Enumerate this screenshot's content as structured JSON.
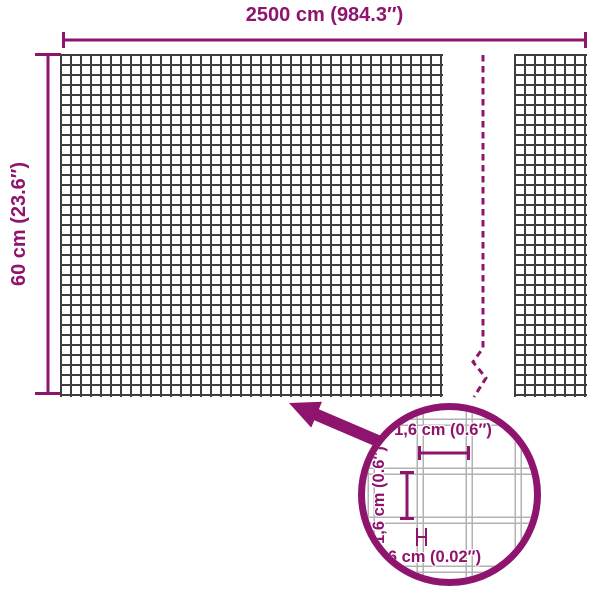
{
  "colors": {
    "accent": "#8e146d",
    "mesh": "#3e3e3e",
    "wire": "#b2b2b2",
    "bg": "#ffffff"
  },
  "dimensions": {
    "width_label": "2500 cm (984.3″)",
    "height_label": "60 cm (23.6″)"
  },
  "detail": {
    "cell_width_label": "1,6 cm (0.6″)",
    "cell_height_label": "1,6 cm (0.6″)",
    "wire_thickness_label": "0,06 cm (0.02″)"
  },
  "icons": {
    "break_line": "zigzag-dashed-break",
    "arrow": "up-left-arrow",
    "magnifier": "zoom-detail-circle"
  }
}
